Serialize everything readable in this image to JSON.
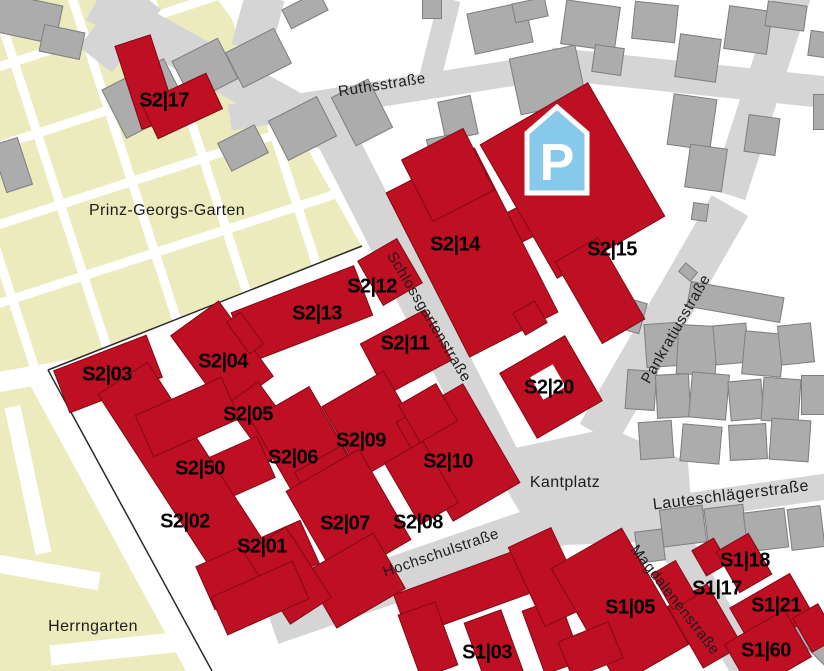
{
  "colors": {
    "campus_building_red": "#be1022",
    "city_building_gray": "#acacac",
    "city_building_border": "#7f7f7f",
    "street_gray": "#d5d5d5",
    "park_green": "#ecebbd",
    "parking_blue": "#86c9ea",
    "label_black": "#000000",
    "path_white": "#ffffff"
  },
  "parking": {
    "glyph": "P",
    "x": 524,
    "y": 104,
    "w": 66,
    "h": 92
  },
  "areas": [
    {
      "text": "Prinz-Georgs-Garten",
      "x": 167,
      "y": 211,
      "rot": 0
    },
    {
      "text": "Herrngarten",
      "x": 93,
      "y": 627,
      "rot": 0
    },
    {
      "text": "Kantplatz",
      "x": 565,
      "y": 483,
      "rot": 0
    }
  ],
  "streets": [
    {
      "id": "ruthsstrasse",
      "label": "Ruthsstraße",
      "x": 382,
      "y": 85,
      "rot": -9
    },
    {
      "id": "schlossgartenstrasse",
      "label": "Schlossgartenstraße",
      "x": 429,
      "y": 317,
      "rot": 59
    },
    {
      "id": "pankratiusstrasse",
      "label": "Pankratiusstraße",
      "x": 676,
      "y": 329,
      "rot": -60
    },
    {
      "id": "hochschulstrasse",
      "label": "Hochschulstraße",
      "x": 441,
      "y": 553,
      "rot": -19
    },
    {
      "id": "lauteschlaegerstrasse",
      "label": "Lauteschlägerstraße",
      "x": 731,
      "y": 496,
      "rot": -7,
      "size": 16
    },
    {
      "id": "magdalenenstrasse",
      "label": "Magdalenenstraße",
      "x": 675,
      "y": 600,
      "rot": 52
    }
  ],
  "street_segments": [
    [
      227,
      75,
      300,
      40,
      29
    ],
    [
      258,
      22,
      40,
      55,
      15
    ],
    [
      120,
      28,
      42,
      80,
      38
    ],
    [
      385,
      93,
      315,
      26,
      -9
    ],
    [
      690,
      78,
      280,
      32,
      6
    ],
    [
      440,
      38,
      22,
      80,
      14
    ],
    [
      762,
      90,
      36,
      220,
      18
    ],
    [
      664,
      320,
      42,
      264,
      30
    ],
    [
      419,
      300,
      40,
      400,
      -27
    ],
    [
      460,
      557,
      400,
      46,
      -19
    ],
    [
      745,
      498,
      170,
      26,
      -8
    ],
    [
      699,
      585,
      34,
      200,
      -30
    ]
  ],
  "kantplatz_polygon": [
    [
      515,
      448
    ],
    [
      610,
      428
    ],
    [
      688,
      462
    ],
    [
      694,
      540
    ],
    [
      540,
      546
    ],
    [
      502,
      482
    ]
  ],
  "park_polygon": [
    [
      0,
      0
    ],
    [
      218,
      0
    ],
    [
      246,
      38
    ],
    [
      362,
      247
    ],
    [
      48,
      370
    ],
    [
      30,
      385
    ],
    [
      186,
      671
    ],
    [
      0,
      671
    ]
  ],
  "park_grid": {
    "cx": 150,
    "cy": 155,
    "w": 420,
    "h": 360,
    "rot": -18,
    "cols": [
      30,
      105,
      180,
      255,
      330
    ],
    "rows": [
      45,
      120,
      195,
      270
    ],
    "thickness": 9
  },
  "park_paths": [
    [
      78,
      368,
      165,
      20,
      -10
    ],
    [
      28,
      480,
      16,
      150,
      -12
    ],
    [
      45,
      572,
      110,
      18,
      10
    ],
    [
      150,
      645,
      200,
      20,
      -6
    ],
    [
      196,
      598,
      14,
      95,
      -28
    ]
  ],
  "fence_lines": [
    [
      48,
      370,
      362,
      246
    ],
    [
      48,
      370,
      212,
      671
    ]
  ],
  "buildings": [
    {
      "label": "S2|17",
      "x": 164,
      "y": 101,
      "shapes": [
        [
          146,
          82,
          38,
          88,
          -18
        ],
        [
          182,
          106,
          72,
          40,
          -25
        ]
      ]
    },
    {
      "label": "S2|14",
      "x": 455,
      "y": 245,
      "shapes": [
        [
          472,
          252,
          100,
          185,
          -27
        ],
        [
          448,
          175,
          70,
          70,
          -27
        ],
        [
          525,
          222,
          24,
          34,
          -27
        ]
      ]
    },
    {
      "label": "S2|15",
      "x": 612,
      "y": 250,
      "shapes": [
        [
          572,
          180,
          125,
          155,
          -30
        ],
        [
          600,
          290,
          50,
          95,
          -30
        ]
      ]
    },
    {
      "label": "S2|12",
      "x": 372,
      "y": 287,
      "shapes": [
        [
          390,
          272,
          46,
          52,
          -30
        ]
      ]
    },
    {
      "label": "S2|13",
      "x": 317,
      "y": 314,
      "shapes": [
        [
          302,
          314,
          132,
          54,
          -21
        ]
      ]
    },
    {
      "label": "S2|11",
      "x": 405,
      "y": 344,
      "shapes": [
        [
          406,
          352,
          74,
          58,
          -28
        ]
      ]
    },
    {
      "label": "S2|03",
      "x": 107,
      "y": 375,
      "shapes": [
        [
          108,
          374,
          100,
          46,
          -21
        ]
      ]
    },
    {
      "label": "S2|04",
      "x": 223,
      "y": 362,
      "shapes": [
        [
          222,
          356,
          60,
          94,
          -36
        ],
        [
          245,
          333,
          18,
          40,
          -36
        ]
      ]
    },
    {
      "label": "S2|05",
      "x": 248,
      "y": 415,
      "shapes": [
        [
          263,
          422,
          40,
          72,
          -36
        ]
      ]
    },
    {
      "label": "S2|20",
      "x": 549,
      "y": 388,
      "shapes": [
        [
          551,
          387,
          76,
          76,
          -30
        ],
        [
          530,
          318,
          26,
          26,
          -30
        ]
      ]
    },
    {
      "label": "S2|06",
      "x": 293,
      "y": 458,
      "shapes": [
        [
          306,
          448,
          68,
          105,
          -30
        ],
        [
          331,
          482,
          55,
          55,
          -30
        ]
      ]
    },
    {
      "label": "S2|09",
      "x": 361,
      "y": 441,
      "shapes": [
        [
          373,
          424,
          72,
          82,
          -30
        ]
      ]
    },
    {
      "label": "S2|10",
      "x": 448,
      "y": 462,
      "shapes": [
        [
          458,
          452,
          78,
          115,
          -30
        ],
        [
          428,
          413,
          44,
          44,
          -30
        ]
      ]
    },
    {
      "label": "S2|50",
      "x": 200,
      "y": 469,
      "shapes": [
        [
          218,
          478,
          105,
          46,
          -24
        ]
      ]
    },
    {
      "label": "S2|02",
      "x": 185,
      "y": 522,
      "shapes": [
        [
          190,
          482,
          60,
          248,
          -33
        ],
        [
          187,
          417,
          95,
          46,
          -24
        ]
      ]
    },
    {
      "label": "S2|07",
      "x": 345,
      "y": 524,
      "shapes": [
        [
          348,
          515,
          85,
          105,
          -30
        ],
        [
          355,
          580,
          80,
          65,
          -30
        ]
      ]
    },
    {
      "label": "S2|08",
      "x": 418,
      "y": 523,
      "shapes": [
        [
          421,
          483,
          45,
          72,
          -30
        ]
      ]
    },
    {
      "label": "S2|01",
      "x": 262,
      "y": 547,
      "shapes": [
        [
          257,
          565,
          115,
          48,
          -24
        ],
        [
          288,
          575,
          50,
          85,
          -33
        ],
        [
          260,
          598,
          90,
          42,
          -24
        ]
      ]
    },
    {
      "label": "S1|03",
      "x": 487,
      "y": 653,
      "shapes": [
        [
          478,
          588,
          165,
          46,
          -20
        ],
        [
          428,
          640,
          40,
          68,
          -20
        ],
        [
          494,
          648,
          40,
          68,
          -20
        ],
        [
          552,
          636,
          40,
          68,
          -20
        ],
        [
          548,
          577,
          48,
          88,
          -25
        ]
      ]
    },
    {
      "label": "S1|05",
      "x": 630,
      "y": 608,
      "shapes": [
        [
          620,
          606,
          82,
          135,
          -30
        ],
        [
          590,
          650,
          55,
          40,
          -22
        ]
      ]
    },
    {
      "label": "S1|17",
      "x": 717,
      "y": 589,
      "shapes": [
        [
          705,
          626,
          46,
          72,
          -30
        ],
        [
          674,
          585,
          28,
          42,
          -30
        ],
        [
          710,
          557,
          26,
          30,
          -30
        ]
      ]
    },
    {
      "label": "S1|18",
      "x": 745,
      "y": 561,
      "shapes": [
        [
          744,
          563,
          38,
          48,
          -30
        ]
      ]
    },
    {
      "label": "S1|21",
      "x": 776,
      "y": 606,
      "shapes": [
        [
          772,
          612,
          70,
          50,
          -30
        ],
        [
          815,
          628,
          30,
          40,
          -30
        ]
      ]
    },
    {
      "label": "S1|60",
      "x": 766,
      "y": 651,
      "shapes": [
        [
          768,
          650,
          70,
          55,
          -30
        ]
      ]
    }
  ],
  "building_holes": [
    [
      548,
      382,
      26,
      26,
      -30
    ]
  ],
  "gray_buildings": [
    [
      25,
      18,
      70,
      40,
      12
    ],
    [
      62,
      42,
      42,
      28,
      12
    ],
    [
      145,
      98,
      70,
      55,
      -27
    ],
    [
      205,
      70,
      52,
      46,
      -27
    ],
    [
      12,
      165,
      28,
      50,
      -18
    ],
    [
      258,
      58,
      55,
      40,
      -27
    ],
    [
      302,
      128,
      55,
      45,
      -27
    ],
    [
      362,
      112,
      42,
      55,
      -27
    ],
    [
      243,
      148,
      42,
      32,
      -27
    ],
    [
      305,
      10,
      42,
      22,
      -27
    ],
    [
      500,
      28,
      60,
      42,
      -12
    ],
    [
      548,
      80,
      68,
      58,
      -12
    ],
    [
      458,
      118,
      34,
      40,
      -12
    ],
    [
      443,
      152,
      28,
      32,
      -12
    ],
    [
      432,
      8,
      20,
      22,
      0
    ],
    [
      530,
      10,
      34,
      20,
      -12
    ],
    [
      590,
      25,
      55,
      45,
      8
    ],
    [
      608,
      60,
      30,
      28,
      8
    ],
    [
      655,
      22,
      44,
      38,
      6
    ],
    [
      698,
      58,
      42,
      44,
      8
    ],
    [
      692,
      122,
      44,
      52,
      8
    ],
    [
      748,
      30,
      44,
      44,
      8
    ],
    [
      786,
      16,
      40,
      26,
      8
    ],
    [
      818,
      44,
      18,
      26,
      8
    ],
    [
      762,
      135,
      32,
      38,
      8
    ],
    [
      820,
      112,
      14,
      36,
      0
    ],
    [
      706,
      168,
      38,
      44,
      8
    ],
    [
      700,
      212,
      16,
      18,
      8
    ],
    [
      688,
      272,
      16,
      12,
      40
    ],
    [
      735,
      302,
      95,
      26,
      10
    ],
    [
      630,
      315,
      28,
      32,
      16
    ],
    [
      662,
      345,
      34,
      44,
      -4
    ],
    [
      697,
      350,
      40,
      50,
      3
    ],
    [
      731,
      344,
      34,
      40,
      -5
    ],
    [
      763,
      354,
      40,
      44,
      5
    ],
    [
      796,
      344,
      34,
      40,
      -6
    ],
    [
      641,
      390,
      30,
      40,
      4
    ],
    [
      673,
      396,
      34,
      44,
      -3
    ],
    [
      709,
      396,
      38,
      46,
      5
    ],
    [
      746,
      400,
      34,
      40,
      -5
    ],
    [
      781,
      400,
      38,
      44,
      4
    ],
    [
      813,
      395,
      24,
      40,
      0
    ],
    [
      656,
      440,
      34,
      38,
      -4
    ],
    [
      701,
      444,
      40,
      38,
      5
    ],
    [
      748,
      442,
      38,
      36,
      -3
    ],
    [
      790,
      440,
      40,
      42,
      4
    ],
    [
      683,
      526,
      44,
      38,
      -7
    ],
    [
      726,
      528,
      40,
      44,
      -7
    ],
    [
      766,
      530,
      42,
      40,
      -7
    ],
    [
      806,
      528,
      34,
      42,
      -7
    ],
    [
      650,
      546,
      28,
      32,
      -7
    ],
    [
      812,
      642,
      56,
      16,
      45
    ]
  ]
}
